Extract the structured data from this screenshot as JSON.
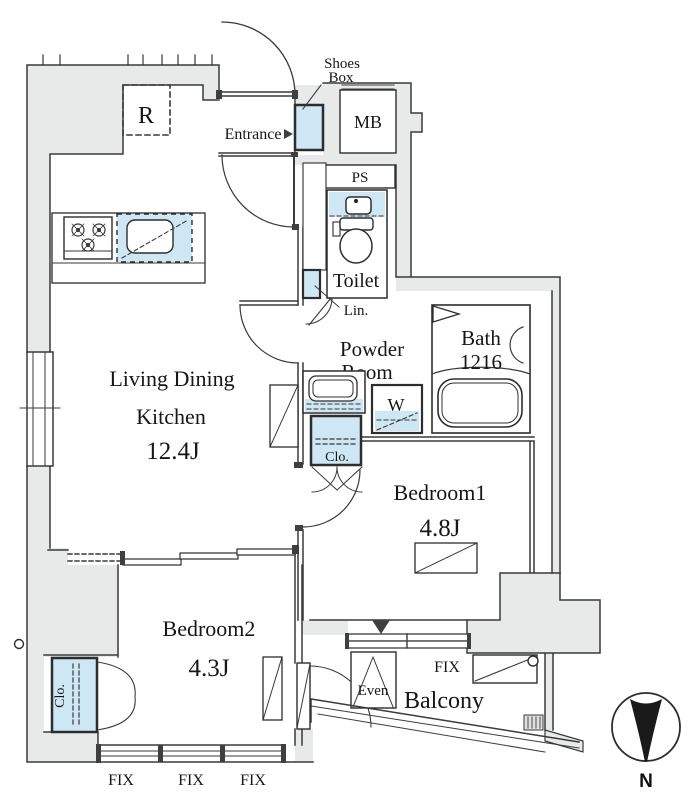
{
  "plan": {
    "rooms": {
      "ldk": {
        "line1": "Living Dining",
        "line2": "Kitchen",
        "size": "12.4J"
      },
      "bedroom1": {
        "name": "Bedroom1",
        "size": "4.8J"
      },
      "bedroom2": {
        "name": "Bedroom2",
        "size": "4.3J"
      },
      "entrance": {
        "name": "Entrance"
      },
      "toilet": {
        "name": "Toilet"
      },
      "powder": {
        "line1": "Powder",
        "line2": "Room"
      },
      "bath": {
        "name": "Bath",
        "size": "1216"
      },
      "balcony": {
        "name": "Balcony"
      }
    },
    "fixtures": {
      "shoes_box_line1": "Shoes",
      "shoes_box_line2": "Box",
      "meter_box": "MB",
      "pipe_space": "PS",
      "linen": "Lin.",
      "washer": "W",
      "closet_hall": "Clo.",
      "closet_bedroom2": "Clo.",
      "refrigerator": "R",
      "evacuation_hatch": "Even"
    },
    "windows": {
      "fix_right": "FIX",
      "fix_labels": [
        "FIX",
        "FIX",
        "FIX"
      ]
    },
    "compass": {
      "north": "N"
    },
    "colors": {
      "fixture_blue": "#cde7f5",
      "wall_gray": "#e8eaea",
      "line": "#3a3a3a",
      "needle_black": "#1a1a1a"
    }
  }
}
